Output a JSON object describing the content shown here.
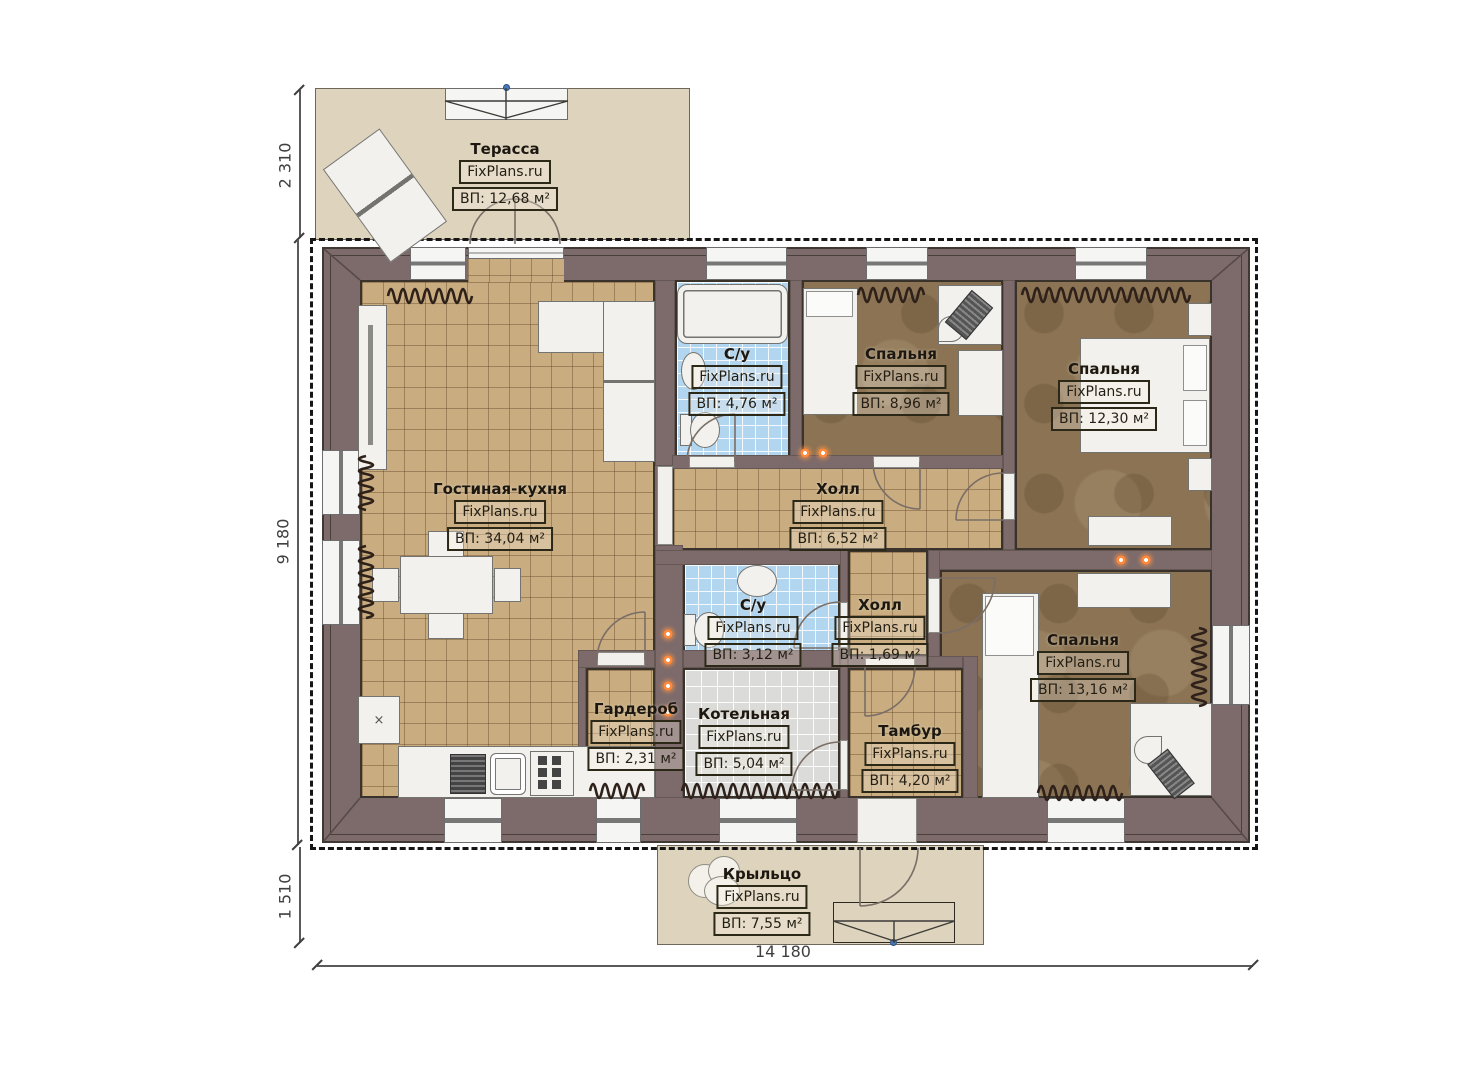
{
  "watermark": "FixPlans.ru",
  "rooms": {
    "terrace": {
      "name": "Терасса",
      "area": "ВП: 12,68 м²"
    },
    "living": {
      "name": "Гостиная-кухня",
      "area": "ВП: 34,04 м²"
    },
    "bath1": {
      "name": "С/у",
      "area": "ВП: 4,76 м²"
    },
    "bedroom1": {
      "name": "Спальня",
      "area": "ВП: 8,96 м²"
    },
    "bedroom2": {
      "name": "Спальня",
      "area": "ВП: 12,30 м²"
    },
    "hall1": {
      "name": "Холл",
      "area": "ВП: 6,52 м²"
    },
    "bath2": {
      "name": "С/у",
      "area": "ВП: 3,12 м²"
    },
    "hall2": {
      "name": "Холл",
      "area": "ВП: 1,69 м²"
    },
    "bedroom3": {
      "name": "Спальня",
      "area": "ВП: 13,16 м²"
    },
    "wardrobe": {
      "name": "Гардероб",
      "area": "ВП: 2,31 м²"
    },
    "boiler": {
      "name": "Котельная",
      "area": "ВП: 5,04 м²"
    },
    "tambour": {
      "name": "Тамбур",
      "area": "ВП: 4,20 м²"
    },
    "porch": {
      "name": "Крыльцо",
      "area": "ВП: 7,55 м²"
    }
  },
  "dimensions": {
    "terrace_depth": "2 310",
    "house_depth": "9 180",
    "porch_depth": "1 510",
    "house_width": "14 180"
  },
  "colors": {
    "wall": "#7d6b6b",
    "floor_tile_tan": "#c9ad80",
    "floor_wood_brown": "#8b7354",
    "floor_tile_blue": "#b2d5f0",
    "floor_tile_gray": "#dbdbd9",
    "outdoor_beige": "#ded3bc",
    "light_accent": "#ff8a3c"
  }
}
